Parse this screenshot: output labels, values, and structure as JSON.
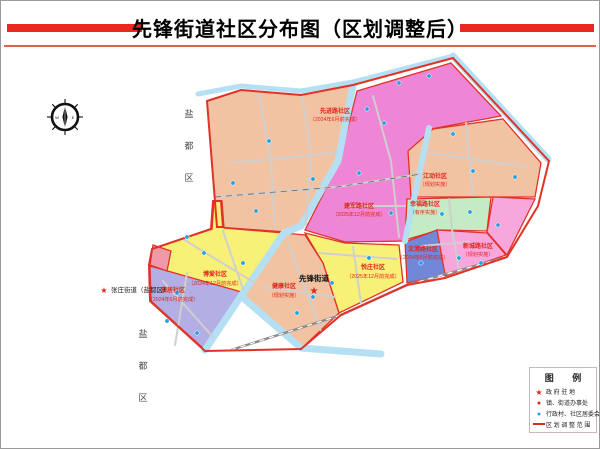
{
  "header": {
    "title": "先锋街道社区分布图（区划调整后）"
  },
  "icons": {
    "star": "★",
    "dot": "●"
  },
  "compass": {
    "west": "W",
    "east": "E"
  },
  "colors": {
    "boundary": "#e23227",
    "label": "#e0251c",
    "water": "#b5dff2",
    "road": "#cfcfcf",
    "railway": "#8e8e8e",
    "committee_dot": "#29a3e0",
    "marker": "#e0251c",
    "accent_bar": "#e8281e",
    "sliver": "#f09aa8"
  },
  "map": {
    "district_chars": [
      "盐",
      "都",
      "区"
    ],
    "street_office": {
      "name": "先锋街道"
    },
    "external_marker": {
      "label": "张庄街道（盐都区）"
    },
    "regions": [
      {
        "id": "xianjin",
        "name": "先进路社区",
        "note": "（2024年6月前完成）",
        "color": "#f2c3a2"
      },
      {
        "id": "jianjun",
        "name": "建军路社区",
        "note": "（2025年12月前完成）",
        "color": "#ee85d5"
      },
      {
        "id": "jiangdong",
        "name": "江动社区",
        "note": "（规划实施）",
        "color": "#f2c3a2"
      },
      {
        "id": "xingfu",
        "name": "幸福路社区",
        "note": "（有序实施）",
        "color": "#c5ebc5"
      },
      {
        "id": "xincheng",
        "name": "新城路社区",
        "note": "（规划实施）",
        "color": "#f7a7dc"
      },
      {
        "id": "wengang",
        "name": "文港路社区",
        "note": "（2024年6月前完成）",
        "color": "#7287d8"
      },
      {
        "id": "yuezhuang",
        "name": "悦庄社区",
        "note": "（2025年12月前完成）",
        "color": "#f8f178"
      },
      {
        "id": "boai",
        "name": "博爱社区",
        "note": "（2024年12月前完成）",
        "color": "#f8f178"
      },
      {
        "id": "kangju",
        "name": "康居社区",
        "note": "（2024年6月前完成）",
        "color": "#b3aee3"
      },
      {
        "id": "jiankang",
        "name": "健康社区",
        "note": "（规划实施）",
        "color": "#f2c3a2"
      }
    ]
  },
  "legend": {
    "title": "图 例",
    "items": [
      {
        "symbol": "star",
        "label": "政 府 驻 地"
      },
      {
        "symbol": "red-dot",
        "label": "镇、街道办事处"
      },
      {
        "symbol": "blue-dot",
        "label": "行政村、社区居委会"
      },
      {
        "symbol": "red-line",
        "label": "区 划 调 整 范 围"
      }
    ]
  }
}
